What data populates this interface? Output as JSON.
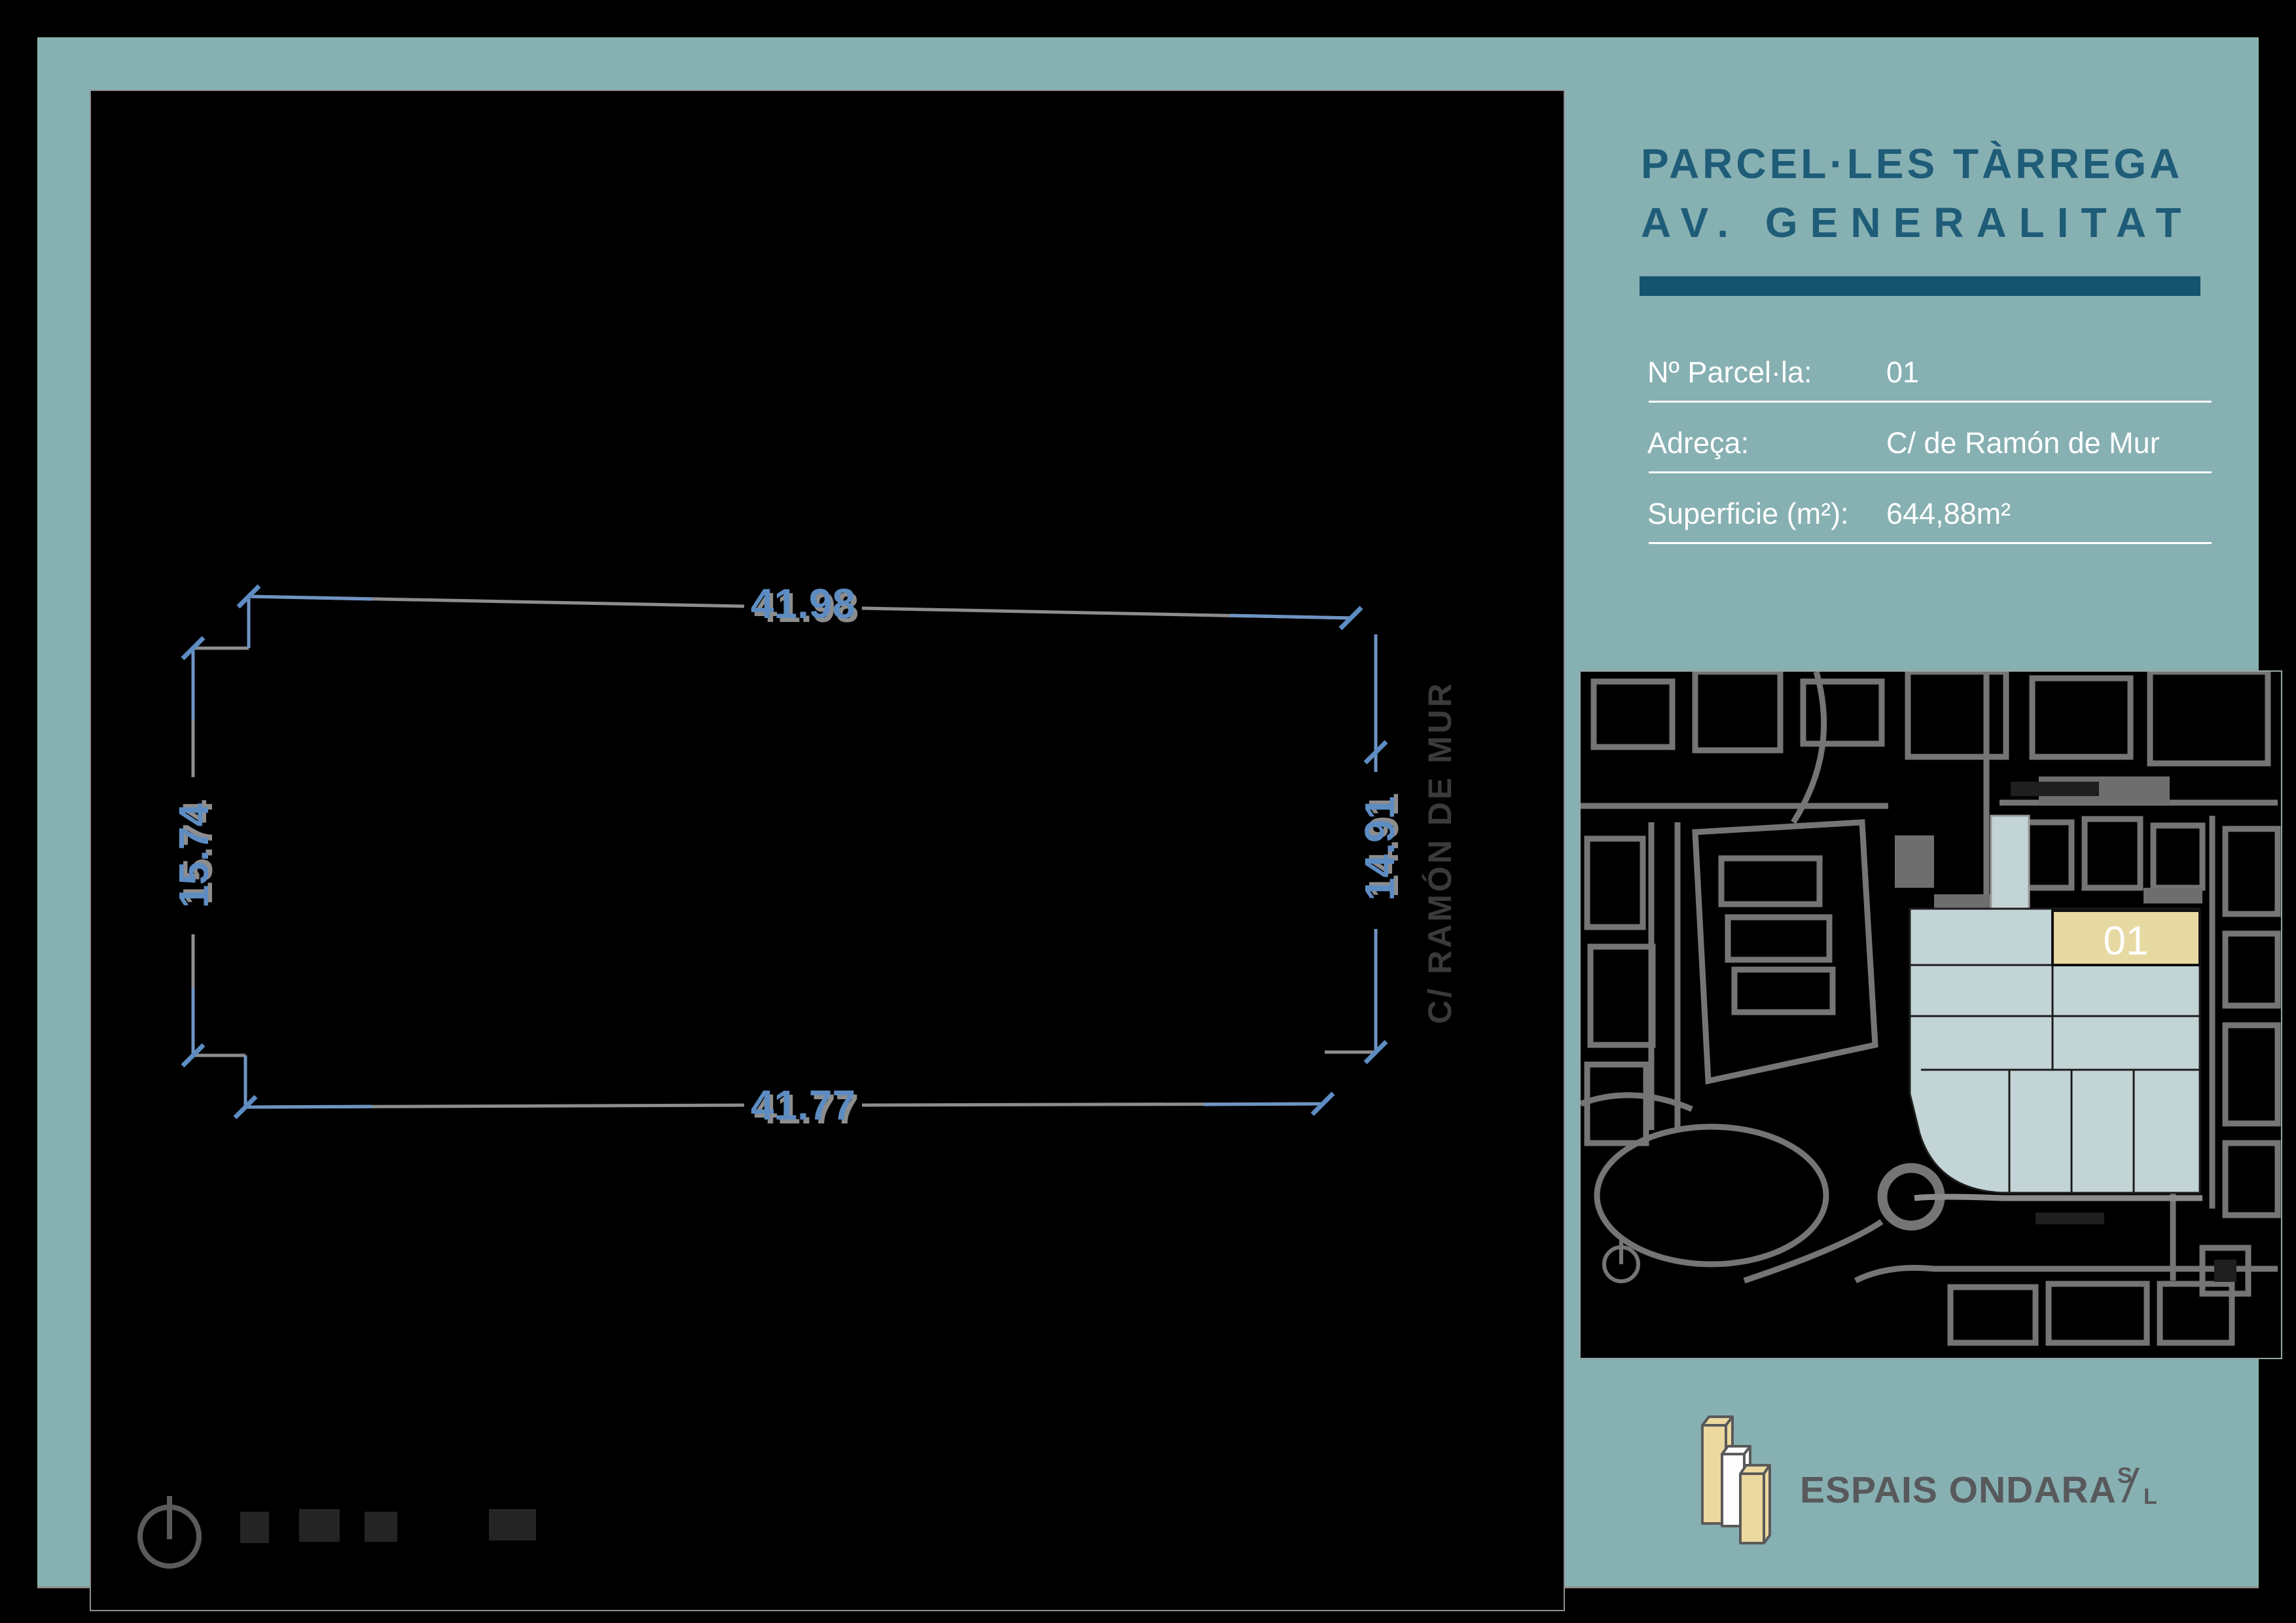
{
  "header": {
    "title_line1": "PARCEL·LES TÀRREGA",
    "title_line2": "AV. GENERALITAT"
  },
  "details": {
    "rows": [
      {
        "label": "Nº Parcel·la:",
        "value": "01"
      },
      {
        "label": "Adreça:",
        "value": "C/ de Ramón de Mur"
      },
      {
        "label": "Superficie (m²):",
        "value": "644,88m²"
      }
    ]
  },
  "drawing": {
    "dim_top": "41.98",
    "dim_bottom": "41.77",
    "dim_left": "15.74",
    "dim_right": "14.91",
    "street": "C/ RAMÓN DE MUR"
  },
  "map": {
    "parcel_label": "01"
  },
  "logo": {
    "text": "ESPAIS ONDARA",
    "suffix_top": "S",
    "suffix_bottom": "L"
  },
  "colors": {
    "sheet_teal": "#87b0b2",
    "dark_teal_bar": "#15536e",
    "title_teal": "#1e5c78",
    "dimension_blue": "#5d8cc2",
    "line_gray": "#8d8d8d",
    "parcel_fill": "#c3d4d6",
    "highlight_fill": "#e7d9a2",
    "logo_tan": "#ecd9a0",
    "logo_text_gray": "#58595b",
    "map_street_gray": "#757575"
  }
}
